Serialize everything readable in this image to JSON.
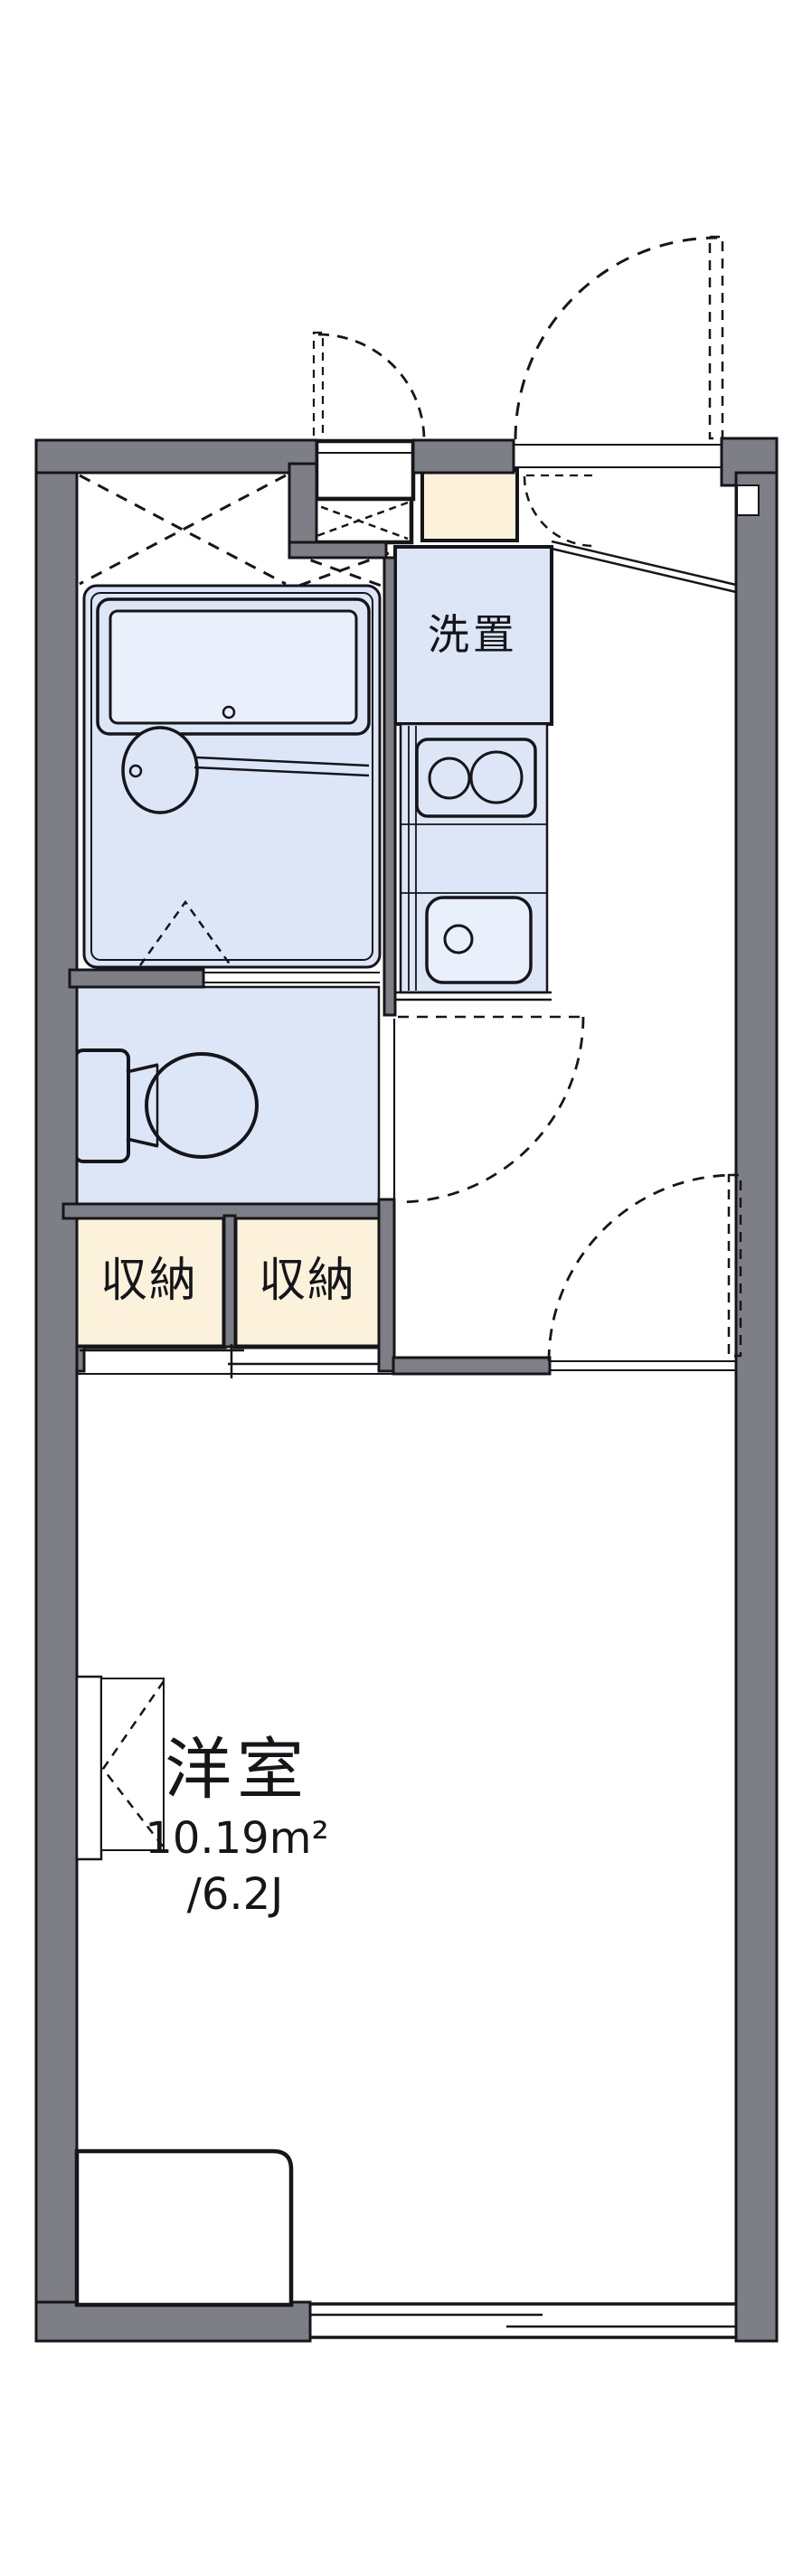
{
  "plan": {
    "type": "japanese-apartment-floor-plan",
    "labels": {
      "washer_space": "洗置",
      "storage_left": "収納",
      "storage_right": "収納"
    },
    "room": {
      "name": "洋室",
      "area": "10.19m²",
      "size": "/6.2J"
    },
    "colors": {
      "wall_gray": "#7e7e86",
      "outline_black": "#15151a",
      "fixture_blue": "#dce6f7",
      "fixture_blue_light": "#e9effb",
      "storage_cream": "#fcf2dc",
      "background": "#ffffff"
    }
  }
}
